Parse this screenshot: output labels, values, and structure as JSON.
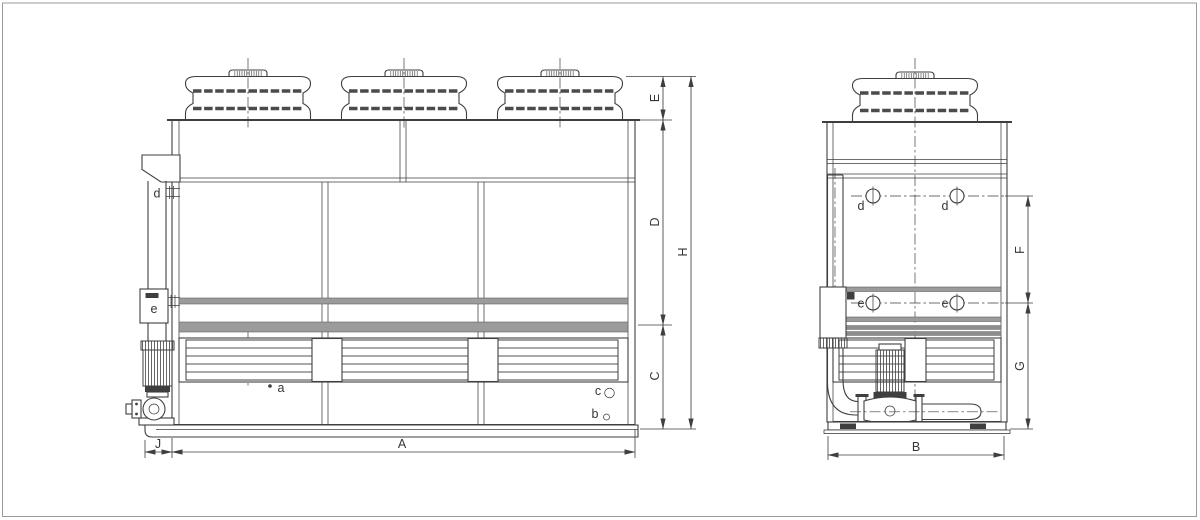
{
  "front": {
    "dim_A": "A",
    "dim_J": "J",
    "dim_C": "C",
    "dim_D": "D",
    "dim_E": "E",
    "dim_H": "H",
    "label_a": "a",
    "label_b": "b",
    "label_c": "c",
    "label_d": "d",
    "label_e": "e"
  },
  "side": {
    "dim_B": "B",
    "dim_F": "F",
    "dim_G": "G",
    "label_d1": "d",
    "label_d2": "d",
    "label_e1": "e",
    "label_e2": "e"
  },
  "colors": {
    "line": "#3f3f3f",
    "band": "#8e8e8e",
    "band_light": "#9b9b9b",
    "background": "#ffffff",
    "page_border": "#9a9a9a"
  }
}
